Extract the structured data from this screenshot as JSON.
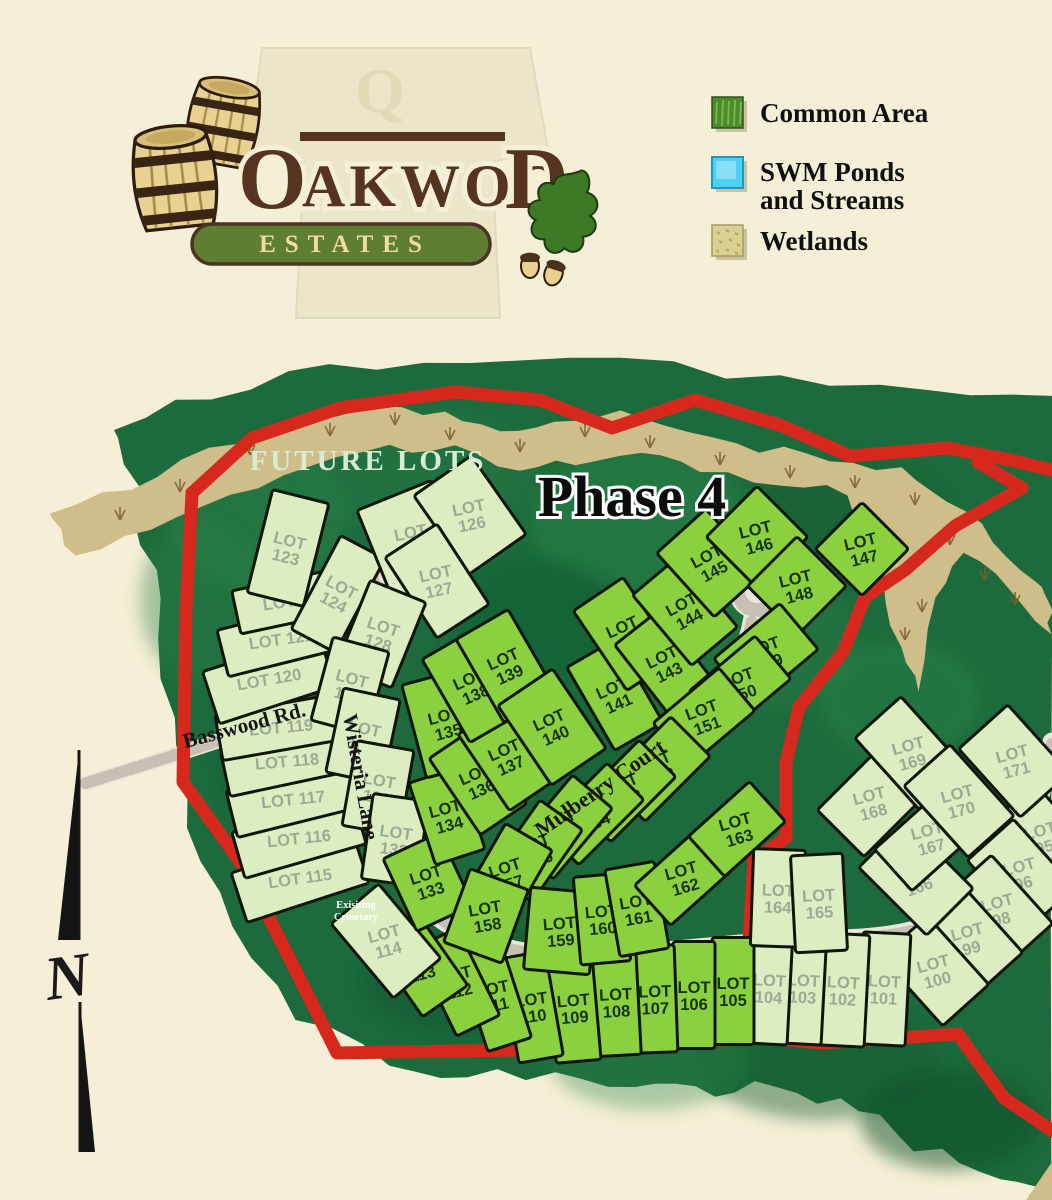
{
  "logo": {
    "name_parts": [
      "O",
      "AKWOO",
      "D"
    ],
    "estates": "ESTATES",
    "watermark_letter": "Q"
  },
  "legend": [
    {
      "id": "common-area",
      "line1": "Common Area",
      "line2": "",
      "color": "#4a8b2c"
    },
    {
      "id": "swm-ponds",
      "line1": "SWM Ponds",
      "line2": "and Streams",
      "color": "#4fd0f2"
    },
    {
      "id": "wetlands",
      "line1": "Wetlands",
      "line2": "",
      "color": "#dbd094"
    }
  ],
  "map": {
    "phase_label": "Phase 4",
    "future_lots_label": "FUTURE LOTS",
    "cemetery_line1": "Exisiting",
    "cemetery_line2": "Cemetary",
    "north_label": "N",
    "roads": [
      {
        "name": "Basswood Rd."
      },
      {
        "name": "Wisteria Lane"
      },
      {
        "name": "Mulberry Court"
      }
    ],
    "colors": {
      "background": "#f4efd6",
      "forest": "#1d6b3c",
      "phase4_lot": "#8bd03e",
      "future_lot": "#dcedc1",
      "lot_outline": "#101607",
      "boundary_red": "#d6281c",
      "wetland_tan": "#cfbd8a",
      "road": "#eae6da",
      "phase4_label_text": "#16330a",
      "future_label_text": "#9aab94"
    },
    "lots": [
      {
        "label": "LOT 95",
        "phase": "future"
      },
      {
        "label": "LOT 96",
        "phase": "future"
      },
      {
        "label": "LOT 98",
        "phase": "future"
      },
      {
        "label": "LOT 99",
        "phase": "future"
      },
      {
        "label": "LOT 100",
        "phase": "future"
      },
      {
        "label": "LOT 101",
        "phase": "future"
      },
      {
        "label": "LOT 102",
        "phase": "future"
      },
      {
        "label": "LOT 103",
        "phase": "future"
      },
      {
        "label": "LOT 104",
        "phase": "future"
      },
      {
        "label": "LOT 105",
        "phase": "phase4"
      },
      {
        "label": "LOT 106",
        "phase": "phase4"
      },
      {
        "label": "LOT 107",
        "phase": "phase4"
      },
      {
        "label": "LOT 108",
        "phase": "phase4"
      },
      {
        "label": "LOT 109",
        "phase": "phase4"
      },
      {
        "label": "LOT 110",
        "phase": "phase4"
      },
      {
        "label": "LOT 111",
        "phase": "phase4"
      },
      {
        "label": "LOT 112",
        "phase": "phase4"
      },
      {
        "label": "LOT 113",
        "phase": "phase4"
      },
      {
        "label": "LOT 114",
        "phase": "future"
      },
      {
        "label": "LOT 115",
        "phase": "future"
      },
      {
        "label": "LOT 116",
        "phase": "future"
      },
      {
        "label": "LOT 117",
        "phase": "future"
      },
      {
        "label": "LOT 118",
        "phase": "future"
      },
      {
        "label": "LOT 119",
        "phase": "future"
      },
      {
        "label": "LOT 120",
        "phase": "future"
      },
      {
        "label": "LOT 121",
        "phase": "future"
      },
      {
        "label": "LOT 122",
        "phase": "future"
      },
      {
        "label": "LOT 123",
        "phase": "future"
      },
      {
        "label": "LOT 124",
        "phase": "future"
      },
      {
        "label": "LOT 125",
        "phase": "future"
      },
      {
        "label": "LOT 126",
        "phase": "future"
      },
      {
        "label": "LOT 127",
        "phase": "future"
      },
      {
        "label": "LOT 128",
        "phase": "future"
      },
      {
        "label": "LOT 129",
        "phase": "future"
      },
      {
        "label": "LOT 130",
        "phase": "future"
      },
      {
        "label": "LOT 131",
        "phase": "future"
      },
      {
        "label": "LOT 132",
        "phase": "future"
      },
      {
        "label": "LOT 133",
        "phase": "phase4"
      },
      {
        "label": "LOT 134",
        "phase": "phase4"
      },
      {
        "label": "LOT 135",
        "phase": "phase4"
      },
      {
        "label": "LOT 136",
        "phase": "phase4"
      },
      {
        "label": "LOT 137",
        "phase": "phase4"
      },
      {
        "label": "LOT 138",
        "phase": "phase4"
      },
      {
        "label": "LOT 139",
        "phase": "phase4"
      },
      {
        "label": "LOT 140",
        "phase": "phase4"
      },
      {
        "label": "LOT 141",
        "phase": "phase4"
      },
      {
        "label": "LOT 142",
        "phase": "phase4"
      },
      {
        "label": "LOT 143",
        "phase": "phase4"
      },
      {
        "label": "LOT 144",
        "phase": "phase4"
      },
      {
        "label": "LOT 145",
        "phase": "phase4"
      },
      {
        "label": "LOT 146",
        "phase": "phase4"
      },
      {
        "label": "LOT 147",
        "phase": "phase4"
      },
      {
        "label": "LOT 148",
        "phase": "phase4"
      },
      {
        "label": "LOT 149",
        "phase": "phase4"
      },
      {
        "label": "LOT 150",
        "phase": "phase4"
      },
      {
        "label": "LOT 151",
        "phase": "phase4"
      },
      {
        "label": "LOT 152",
        "phase": "phase4"
      },
      {
        "label": "LOT 153",
        "phase": "phase4"
      },
      {
        "label": "LOT 154",
        "phase": "phase4"
      },
      {
        "label": "LOT 155",
        "phase": "phase4"
      },
      {
        "label": "LOT 156",
        "phase": "phase4"
      },
      {
        "label": "LOT 157",
        "phase": "phase4"
      },
      {
        "label": "LOT 158",
        "phase": "phase4"
      },
      {
        "label": "LOT 159",
        "phase": "phase4"
      },
      {
        "label": "LOT 160",
        "phase": "phase4"
      },
      {
        "label": "LOT 161",
        "phase": "phase4"
      },
      {
        "label": "LOT 162",
        "phase": "phase4"
      },
      {
        "label": "LOT 163",
        "phase": "phase4"
      },
      {
        "label": "LOT 164",
        "phase": "future"
      },
      {
        "label": "LOT 165",
        "phase": "future"
      },
      {
        "label": "LOT 166",
        "phase": "future"
      },
      {
        "label": "LOT 167",
        "phase": "future"
      },
      {
        "label": "LOT 168",
        "phase": "future"
      },
      {
        "label": "LOT 169",
        "phase": "future"
      },
      {
        "label": "LOT 170",
        "phase": "future"
      },
      {
        "label": "LOT 171",
        "phase": "future"
      }
    ]
  }
}
